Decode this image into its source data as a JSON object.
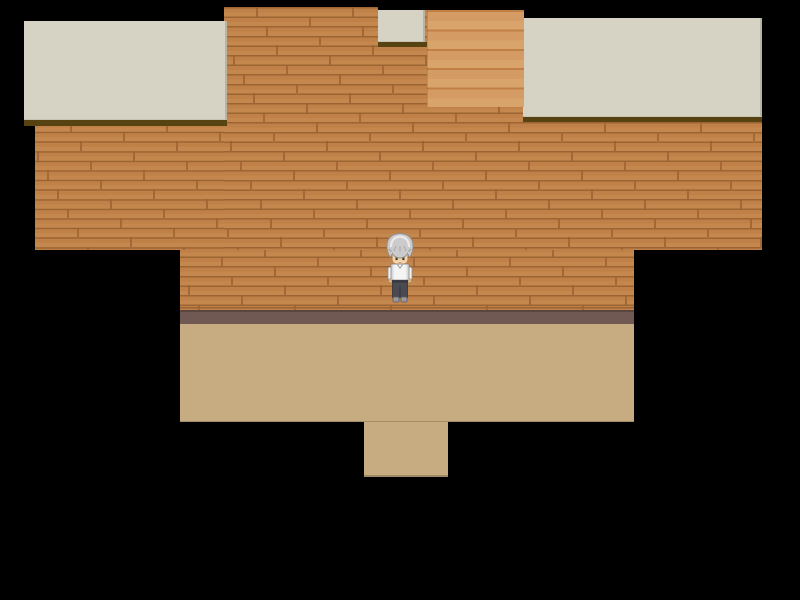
{
  "app": {
    "name": "rpg-game-viewport",
    "scene": "wooden-room-interior",
    "visible_text": []
  },
  "palette": {
    "background": "#000000",
    "wall": "#bf8148",
    "wall_seam": "#9c6433",
    "ceiling": "#d6d3c5",
    "ceiling_shadow": "#564311",
    "stairs_light": "#d49c64",
    "stairs_dark": "#c08045",
    "baseboard": "#6f5952",
    "baseboard_edge": "#5a4640",
    "floor": "#c8ac81"
  },
  "character": {
    "id": "player-character",
    "description": "gray-haired man in white shirt and dark trousers, facing down",
    "hair_color": "#cbcbcb",
    "hair_highlight_color": "#eaeaea",
    "skin_color": "#f6d3a8",
    "shirt_color": "#f4f4f4",
    "pants_color": "#4a4a52",
    "shoes_color": "#98979c"
  }
}
